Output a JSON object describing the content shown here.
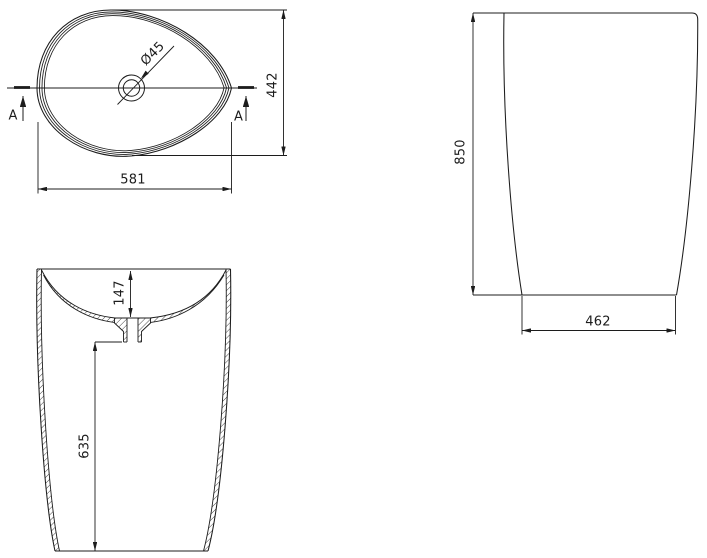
{
  "drawing": {
    "colors": {
      "background": "#ffffff",
      "line": "#1c1c1c"
    },
    "top_view": {
      "drain_diameter_label": "Ø45",
      "overall_width": "581",
      "overall_depth": "442",
      "section_marker": "A"
    },
    "section_view": {
      "bowl_depth": "147",
      "under_drain_height": "635"
    },
    "front_view": {
      "overall_height": "850",
      "base_width": "462"
    }
  }
}
